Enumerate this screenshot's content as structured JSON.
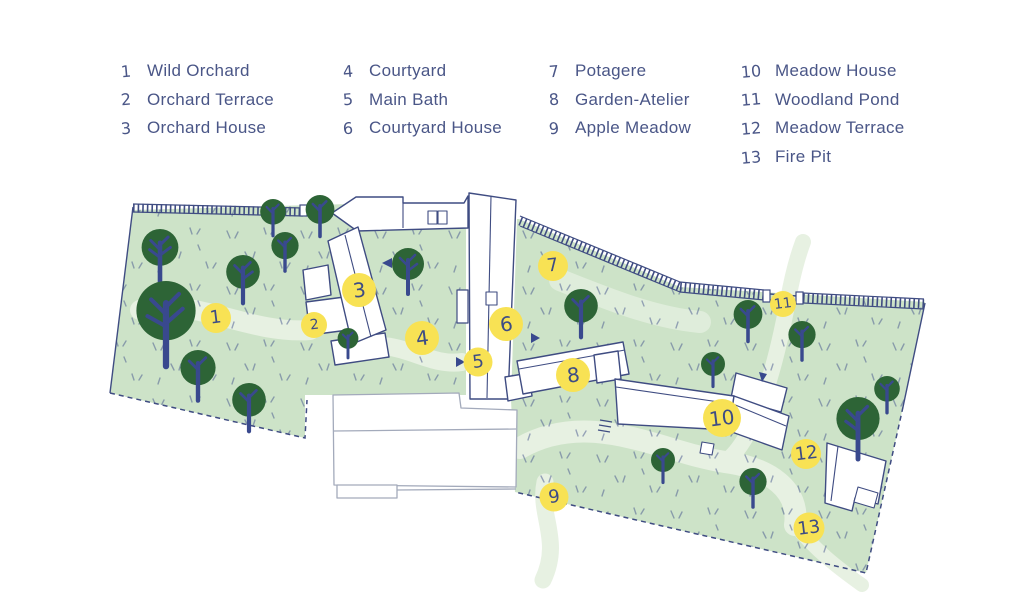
{
  "locations": [
    {
      "num": "1",
      "label": "Wild Orchard"
    },
    {
      "num": "2",
      "label": "Orchard Terrace"
    },
    {
      "num": "3",
      "label": "Orchard House"
    },
    {
      "num": "4",
      "label": "Courtyard"
    },
    {
      "num": "5",
      "label": "Main Bath"
    },
    {
      "num": "6",
      "label": "Courtyard House"
    },
    {
      "num": "7",
      "label": "Potagere"
    },
    {
      "num": "8",
      "label": "Garden-Atelier"
    },
    {
      "num": "9",
      "label": "Apple Meadow"
    },
    {
      "num": "10",
      "label": "Meadow House"
    },
    {
      "num": "11",
      "label": "Woodland Pond"
    },
    {
      "num": "12",
      "label": "Meadow Terrace"
    },
    {
      "num": "13",
      "label": "Fire Pit"
    }
  ],
  "colors": {
    "ink_navy": "#3F4C82",
    "text_navy": "#4A5687",
    "field_green": "#CDE3C8",
    "path_green": "#E7F1E2",
    "tree_green": "#2D6436",
    "trunk_navy": "#39498E",
    "marker_yellow": "#F8E254",
    "neighbor_gray": "#A3AABB"
  }
}
